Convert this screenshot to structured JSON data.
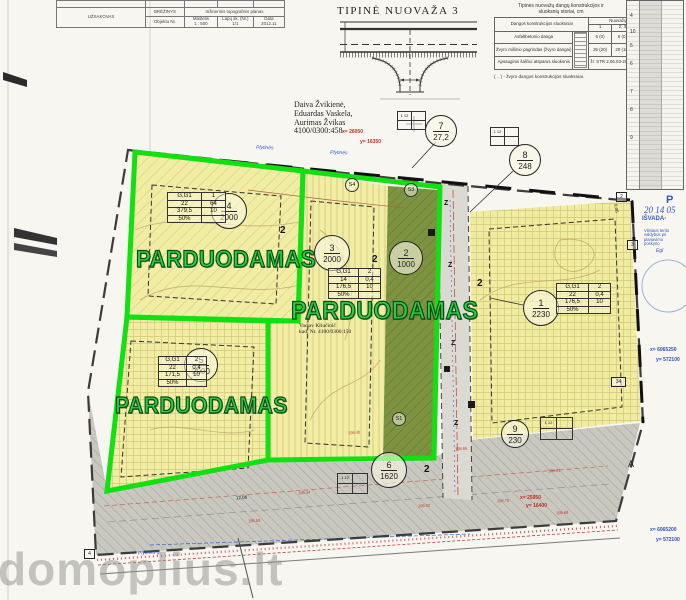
{
  "title_block": {
    "uzsakovas": "UŽSAKOVAS",
    "brezinys_label": "BRĖŽINYS",
    "brezinys_value": "Inžinerinis topografinis planas",
    "objekto_nr": "Objekto Nr.",
    "mastelis_label": "Mastelis",
    "mastelis_value": "1 : 500",
    "lapu_label": "Lapų sk. (Nr.)",
    "lapu_value": "1/1",
    "data_label": "Data",
    "data_value": "2012.11"
  },
  "nuovaza_title": "TIPINĖ NUOVAŽA 3",
  "construction_table": {
    "title1": "Tipinės nuovažų dangų konstrukcijos ir",
    "title2": "sluoksnių storiai, cm",
    "col_left": "Dangos konstrukcijos sluoksniai",
    "col_right": "Nuovažų tipai",
    "type_cols": [
      "1",
      "2; 3",
      "4; 5"
    ],
    "row1_label": "Asfaltbetonio danga",
    "row1_values": [
      "6 (0)",
      "6 (0)",
      "6 (0)"
    ],
    "row2_label": "Žvyro mišinio pagrindas (žvyro dangai)",
    "row2_values": [
      "25 (20)",
      "20 (16)",
      "20 (16)"
    ],
    "row3_label": "Apsauginis šalčiui atsparus sluoksnis",
    "row3_value": "žr. STR 2.06.03-2001 C.4 lentelę",
    "footnote": "( .. ) - žvyro dangos konstrukcijos sluoksniai."
  },
  "coord_table": {
    "groups": [
      "4",
      "10",
      "5",
      "6",
      "7",
      "8",
      "9"
    ]
  },
  "stamp": {
    "line1": "P",
    "line2": "20  14 05",
    "line3": "IŠVADA-",
    "line4": "Vilniaus terito",
    "line5": "valdybos pri",
    "line6": "planavimo",
    "line7": "poskyrio",
    "line8": "Egl"
  },
  "owners": {
    "line1": "Daiva Žvikienė,",
    "line2": "Eduardas Vaskela,",
    "line3": "Aurimas Žvikas",
    "line4": "4100/0300:458"
  },
  "plot_owner2": {
    "line1": "Vaclav Kliučinič",
    "line2": "kad. Nr. 4100/0300:150"
  },
  "for_sale_label": "PARDUODAMAS",
  "circles": [
    {
      "num": "7",
      "area": "27,2"
    },
    {
      "num": "8",
      "area": "248"
    },
    {
      "num": "4",
      "area": "2000"
    },
    {
      "num": "3",
      "area": "2000"
    },
    {
      "num": "2",
      "area": "1000"
    },
    {
      "num": "1",
      "area": "2230"
    },
    {
      "num": "5",
      "area": "2000"
    },
    {
      "num": "6",
      "area": "1620"
    },
    {
      "num": "9",
      "area": "230"
    }
  ],
  "plot_tables": {
    "p4": {
      "r1c1": "G,G1",
      "r1c2": "1",
      "r2c1": "22",
      "r2c2": "64",
      "r3c1": "379,5",
      "r3c2": "10",
      "r4c1": "50%"
    },
    "p3": {
      "r1c1": "G,G1",
      "r1c2": "2",
      "r2c1": "14",
      "r2c2": "0,4",
      "r3c1": "176,5",
      "r3c2": "10",
      "r4c1": "50%"
    },
    "p1": {
      "r1c1": "G,G1",
      "r1c2": "2",
      "r2c1": "22",
      "r2c2": "0,4",
      "r3c1": "176,5",
      "r3c2": "10",
      "r4c1": "50%"
    },
    "p5": {
      "r1c1": "G,G1",
      "r1c2": "2",
      "r2c1": "22",
      "r2c2": "0,4",
      "r3c1": "171,5",
      "r3c2": "10",
      "r4c1": "50%"
    }
  },
  "grid_box_label": "1 12",
  "coords_red": {
    "top_x": "x= 26050",
    "top_y": "y= 16350",
    "bottom_x": "x= 25950",
    "bottom_y": "y= 16400"
  },
  "coords_blue": {
    "mid_x": "x= 6065250",
    "mid_y": "y= 572100",
    "bottom_x": "x= 6065200",
    "bottom_y": "y= 572100"
  },
  "road_labels": {
    "plytines_1": "Plytinės",
    "plytines_2": "Plytinės",
    "plytines_3": "Plytinės g."
  },
  "s_labels": {
    "s4": "S4",
    "s3": "S3",
    "s1": "S1"
  },
  "z_label": "Z",
  "point_numbers": {
    "n2a": "2",
    "n2b": "2",
    "n2c": "2",
    "n2d": "2",
    "box2": "2",
    "box3": "3",
    "box34": "34",
    "box4": "4"
  },
  "misc_labels": {
    "a_label": "A",
    "dim1": "12,06",
    "dim2": "5,06"
  },
  "elevations": [
    "198.40",
    "198.65",
    "198.81",
    "198.44",
    "198.75",
    "198.68",
    "199.02",
    "198.58"
  ],
  "watermark": "domoplius.lt"
}
